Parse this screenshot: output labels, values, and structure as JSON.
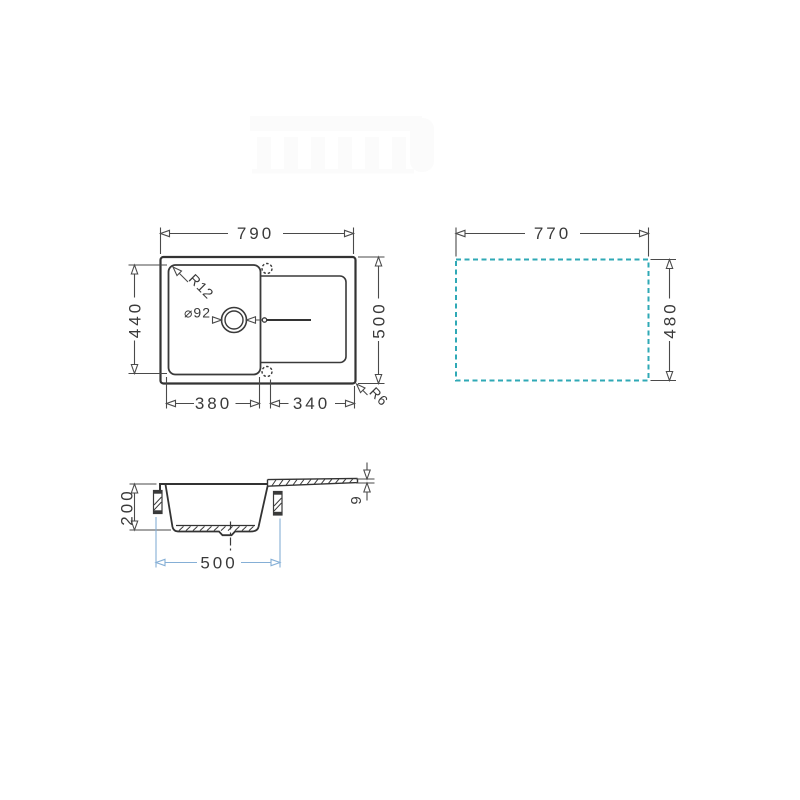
{
  "drawing": {
    "type": "sink-technical-drawing",
    "top_view": {
      "overall_width_label": "790",
      "overall_depth_label": "500",
      "bowl_depth_label": "440",
      "bowl_width_label": "380",
      "drainer_width_label": "340",
      "bowl_corner_radius_label": "R12",
      "outer_corner_radius_label": "R6",
      "drain_diameter_label": "⌀92"
    },
    "cutout_view": {
      "cutout_width_label": "770",
      "cutout_depth_label": "480"
    },
    "side_view": {
      "bowl_height_label": "200",
      "bowl_base_width_label": "500",
      "rim_thickness_label": "9"
    }
  },
  "colors": {
    "line": "#3a3a3a",
    "dim_line": "#4a4a4a",
    "cutout_teal": "#2fa9b6",
    "blue_dim_line": "#85afd6",
    "blue_dim_text": "#3f7fc1",
    "watermark": "#fbfbfb",
    "background": "#ffffff"
  }
}
